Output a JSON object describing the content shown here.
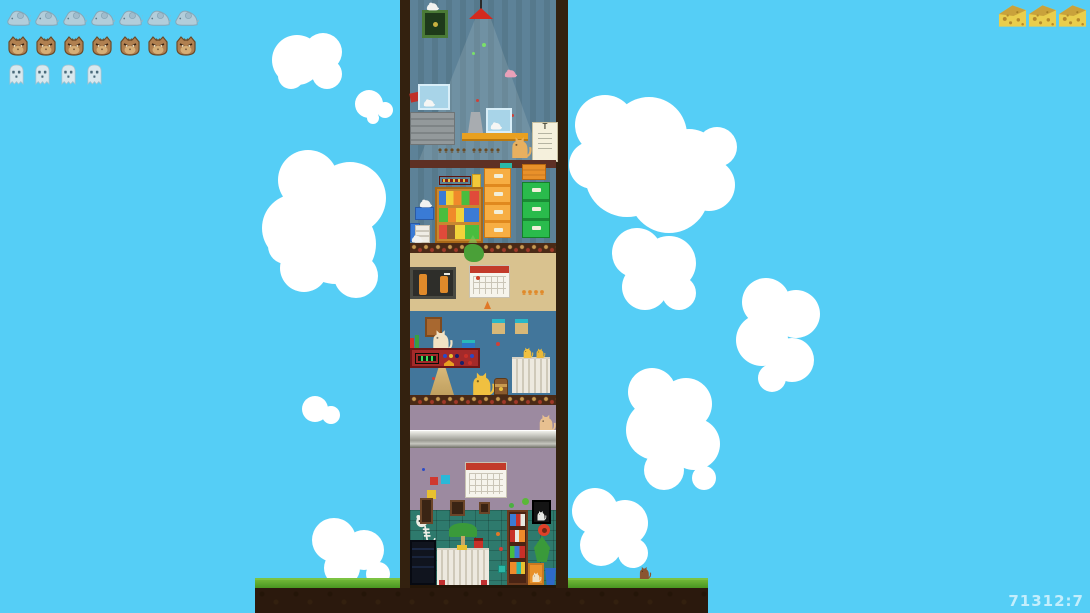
{
  "hud": {
    "mice_row": {
      "icon": "mouse-icon",
      "count": 7
    },
    "cats_row": {
      "icon": "cat-icon",
      "count": 7
    },
    "ghosts_row": {
      "icon": "ghost-icon",
      "count": 4
    },
    "cheese_row": {
      "icon": "cheese-icon",
      "count": 3
    }
  },
  "score": {
    "text": "71312:7"
  },
  "eye_chart": {
    "top_letter": "T"
  },
  "colors": {
    "sky": "#55CEF6",
    "cloud": "#FFFFFF",
    "grass": "#4E9E20",
    "dirt": "#2B190D",
    "tower_wall": "#33210F",
    "wallpaper_blue": "#5D8298",
    "office_tan": "#D9C28F",
    "office_blue": "#42769B",
    "lounge_purple": "#9C8AA0",
    "basement_teal": "#2E7A6D",
    "lamp_red": "#D42A1E",
    "cabinet_orange": "#F59B27",
    "cabinet_green": "#2ABB4C"
  }
}
